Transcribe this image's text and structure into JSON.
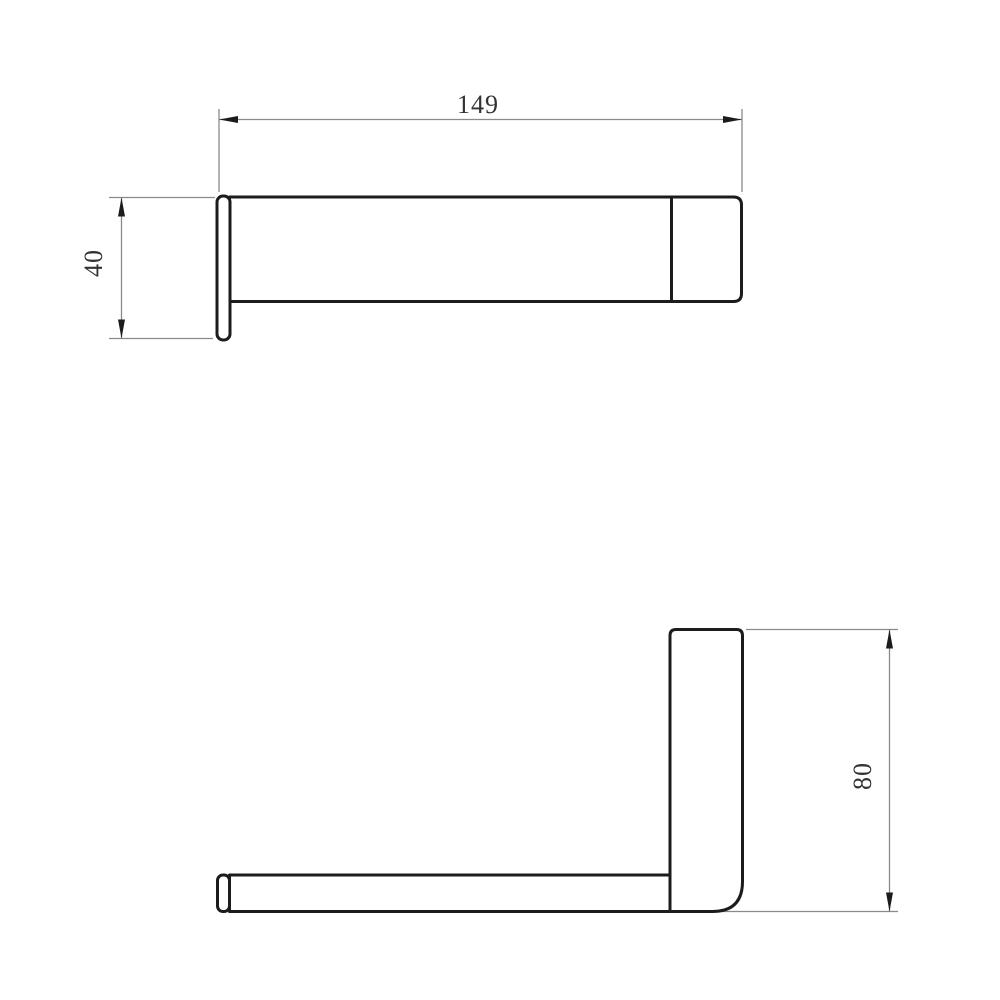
{
  "drawing": {
    "type": "technical-dimension-drawing",
    "views": {
      "top_view": {
        "width_dimension_label": "149",
        "depth_dimension_label": "40"
      },
      "side_view": {
        "height_dimension_label": "80"
      }
    }
  },
  "colors": {
    "background": "#ffffff",
    "part_outline": "#1c1c1c",
    "dimension_line": "#8a8a8a",
    "dimension_text": "#333333"
  }
}
